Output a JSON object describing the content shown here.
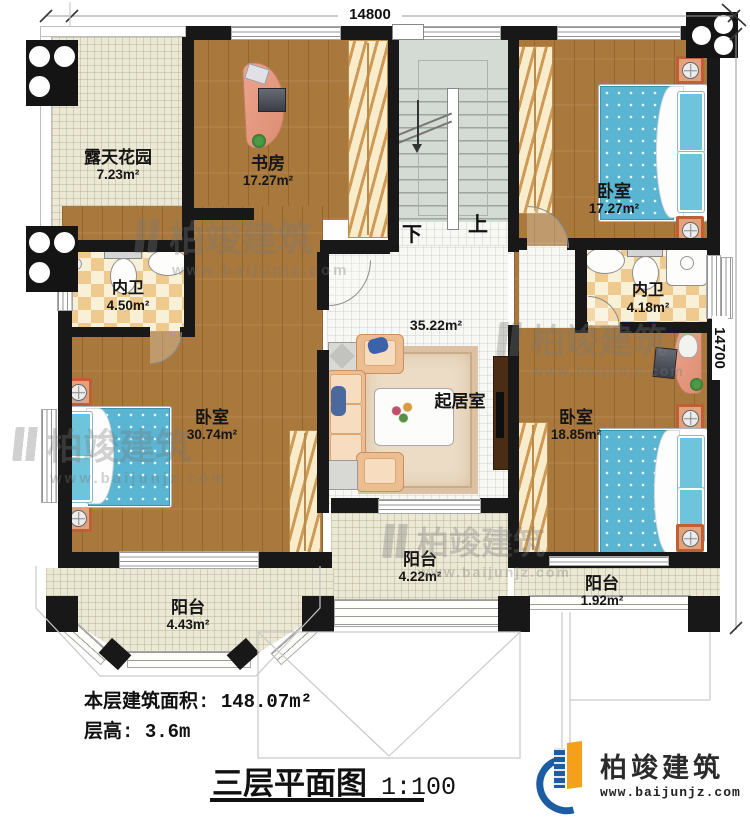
{
  "dimensions": {
    "top": "14800",
    "right": "14700"
  },
  "rooms": [
    {
      "name": "露天花园",
      "area": "7.23m²"
    },
    {
      "name": "书房",
      "area": "17.27m²"
    },
    {
      "name": "卧室",
      "area": "17.27m²"
    },
    {
      "name": "内卫",
      "area": "4.50m²"
    },
    {
      "name": "卧室",
      "area": "30.74m²"
    },
    {
      "name": "起居室",
      "area": "35.22m²"
    },
    {
      "name": "内卫",
      "area": "4.18m²"
    },
    {
      "name": "卧室",
      "area": "18.85m²"
    },
    {
      "name": "阳台",
      "area": "4.43m²"
    },
    {
      "name": "阳台",
      "area": "4.22m²"
    },
    {
      "name": "阳台",
      "area": "1.92m²"
    }
  ],
  "stairs": {
    "up": "上",
    "down": "下"
  },
  "footer": {
    "floor_area_label": "本层建筑面积:",
    "floor_area_value": "148.07m²",
    "floor_height_label": "层高:",
    "floor_height_value": "3.6m",
    "title": "三层平面图",
    "scale": "1:100"
  },
  "watermark": {
    "brand": "柏竣建筑",
    "url": "www.baijunjz.com"
  },
  "logo": {
    "brand": "柏竣建筑",
    "url": "www.baijunjz.com"
  },
  "colors": {
    "wall": "#181818",
    "wood": "#a9783c",
    "outdoor_tile": "#ebe8d6",
    "indoor_tile": "#f7f7f3",
    "bath_checker": "#eeca8e",
    "stairs": "#d4dad4",
    "bed": "#5ab5d2",
    "logo_blue": "#1c5ca3",
    "logo_orange": "#f5a01a"
  }
}
